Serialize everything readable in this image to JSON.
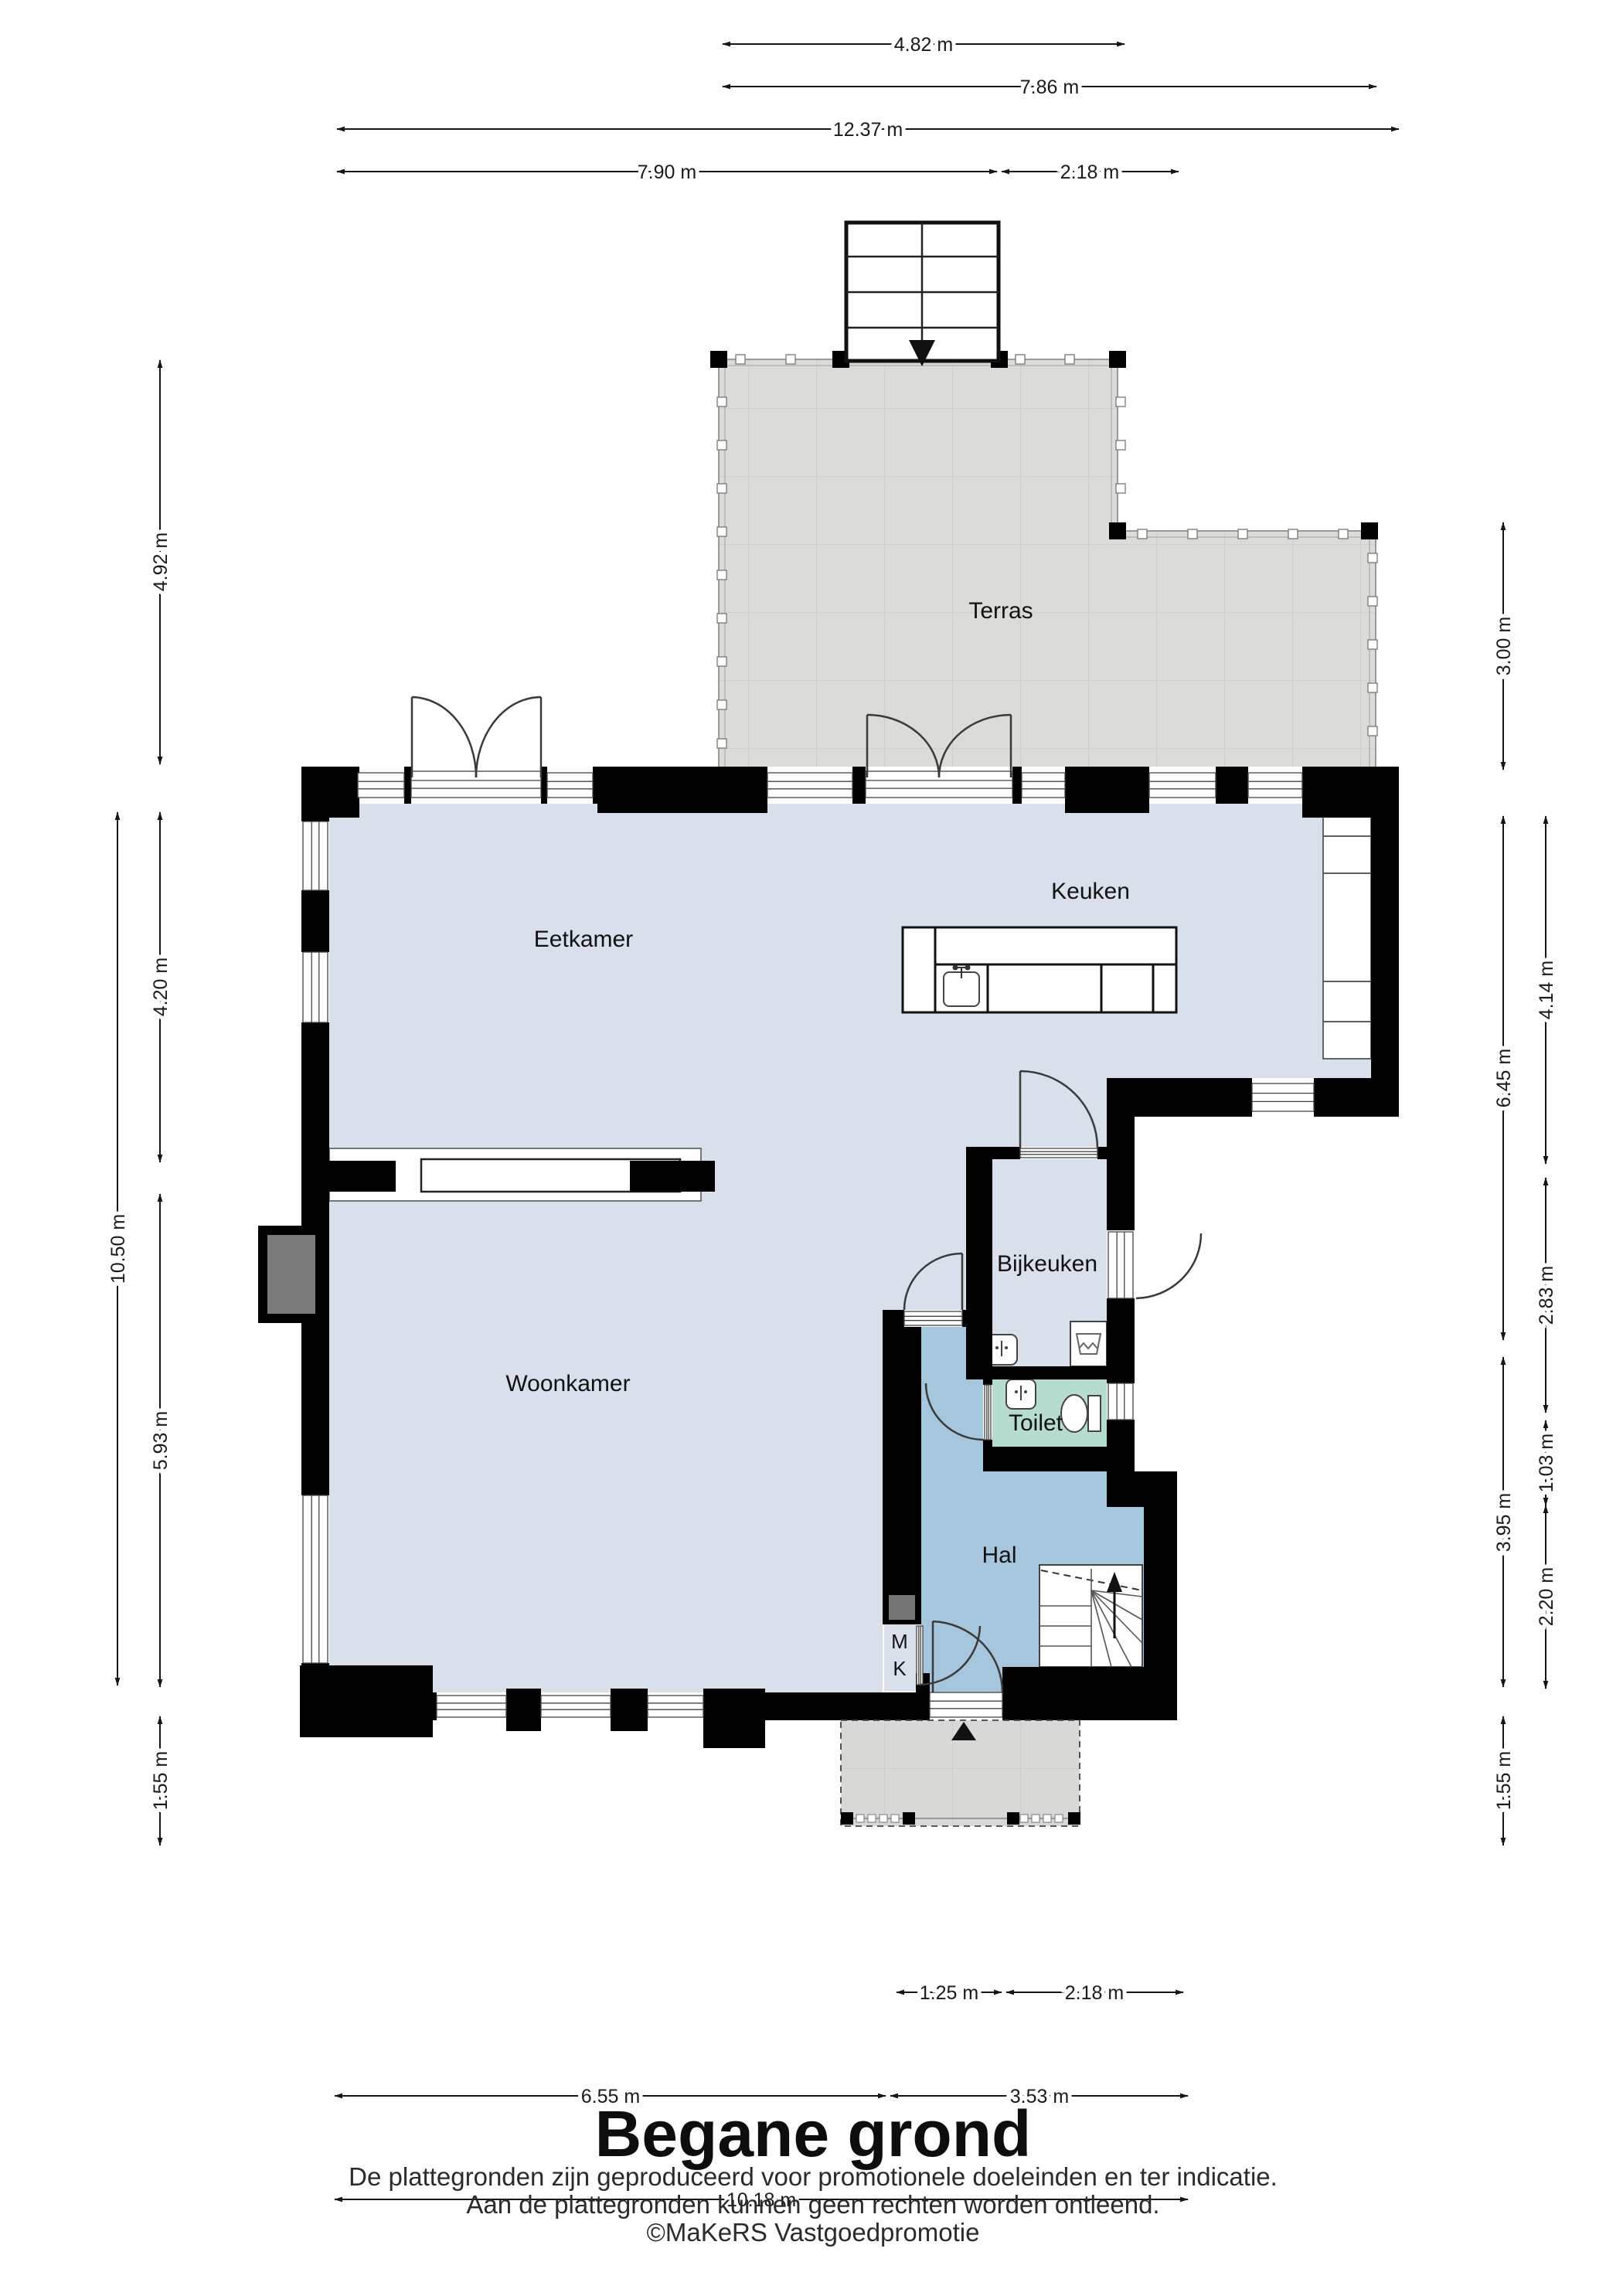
{
  "page": {
    "title": "Begane grond",
    "disclaimer_line1": "De plattegronden zijn geproduceerd voor promotionele doeleinden en ter indicatie.",
    "disclaimer_line2": "Aan de plattegronden kunnen geen rechten worden ontleend.",
    "credit": "©MaKeRS Vastgoedpromotie"
  },
  "rooms": {
    "terras": "Terras",
    "keuken": "Keuken",
    "eetkamer": "Eetkamer",
    "bijkeuken": "Bijkeuken",
    "woonkamer": "Woonkamer",
    "toilet": "Toilet",
    "hal": "Hal",
    "mk_line1": "M",
    "mk_line2": "K"
  },
  "dimensions": {
    "top": {
      "d482": "4.82 m",
      "d786": "7.86 m",
      "d1237": "12.37 m",
      "d790": "7.90 m",
      "d218": "2.18 m"
    },
    "left": {
      "d492": "4.92 m",
      "d420": "4.20 m",
      "d1050": "10.50 m",
      "d593": "5.93 m",
      "d155": "1.55 m"
    },
    "right": {
      "d300": "3.00 m",
      "d414": "4.14 m",
      "d645": "6.45 m",
      "d283": "2.83 m",
      "d103": "1.03 m",
      "d395": "3.95 m",
      "d220": "2.20 m",
      "d155": "1.55 m"
    },
    "bottom": {
      "d125": "1.25 m",
      "d218": "2.18 m",
      "d655": "6.55 m",
      "d353": "3.53 m",
      "d1018": "10.18 m"
    }
  },
  "icons": {
    "stairs_down_icon": "solid triangle pointing down (stairs down to terrace)",
    "stairs_up_icon": "arrow pointing up (stairs to first floor)",
    "entrance_icon": "solid triangle pointing up (entrance)"
  },
  "colors": {
    "wall": "#000000",
    "room_floor": "#d9dfeb",
    "hall_floor": "#a6c6dd",
    "toilet_floor": "#b6dccf",
    "terrace": "#dbdbd8",
    "porch": "#d8d8d6",
    "fusebox": "#757575",
    "chimney": "#7a7a7a"
  }
}
